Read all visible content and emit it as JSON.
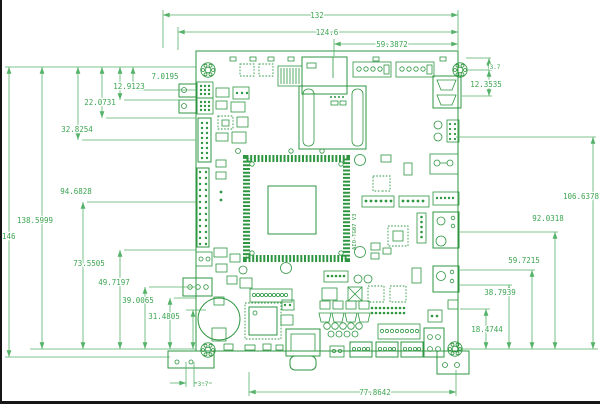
{
  "drawing": {
    "silk_text": "AIO-TG07 V3",
    "colors": {
      "board": "#2e9640",
      "dims": "#55b269",
      "background": "#ffffff"
    }
  },
  "dims": {
    "top": [
      "132",
      "124.6",
      "59.3872"
    ],
    "left_upper": [
      "7.0195",
      "12.9123",
      "22.0731",
      "32.8254"
    ],
    "left_lower": [
      "94.6828",
      "138.5999",
      "73.5505",
      "49.7197",
      "39.0065",
      "31.4805"
    ],
    "height": "146",
    "right": [
      "106.6378",
      "92.0318",
      "59.7215",
      "38.7939",
      "18.4744"
    ],
    "right_small": [
      "3.7",
      "12.3535"
    ],
    "bottom": [
      "3.7",
      "77.8642"
    ]
  }
}
